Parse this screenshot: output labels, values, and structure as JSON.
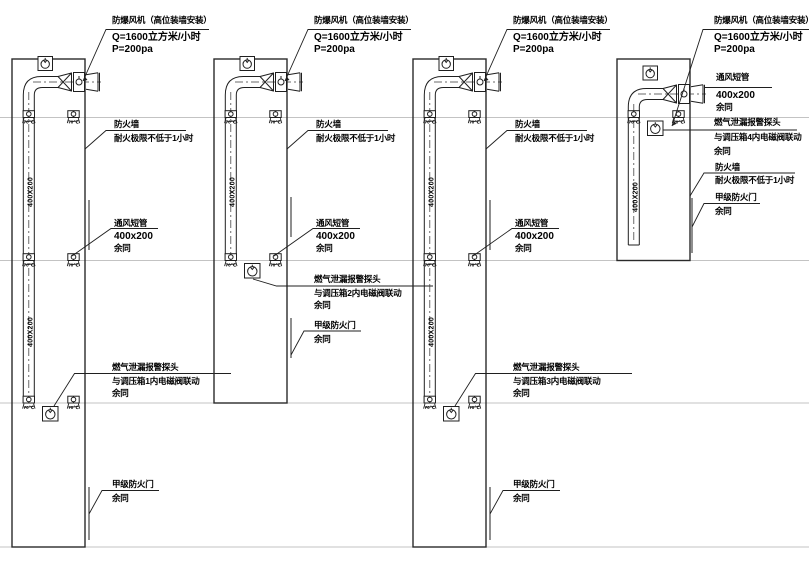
{
  "shared": {
    "duct_size_vertical": "400X200",
    "damper_temp": "70℃"
  },
  "panels": [
    {
      "fan_title": "防爆风机（高位装墙安装）",
      "fan_q": "Q=1600立方米/小时",
      "fan_p": "P=200pa",
      "firewall": "防火墙",
      "firewall_rating": "耐火极限不低于1小时",
      "vent": "通风短管",
      "vent_size": "400x200",
      "vent_same": "余同",
      "sensor": "燃气泄漏报警探头",
      "sensor_link": "与调压箱1内电磁阀联动",
      "sensor_same": "余同",
      "door": "甲级防火门",
      "door_same": "余同"
    },
    {
      "fan_title": "防爆风机（高位装墙安装）",
      "fan_q": "Q=1600立方米/小时",
      "fan_p": "P=200pa",
      "firewall": "防火墙",
      "firewall_rating": "耐火极限不低于1小时",
      "vent": "通风短管",
      "vent_size": "400x200",
      "vent_same": "余同",
      "sensor": "燃气泄漏报警探头",
      "sensor_link": "与调压箱2内电磁阀联动",
      "sensor_same": "余同",
      "door": "甲级防火门",
      "door_same": "余同"
    },
    {
      "fan_title": "防爆风机（高位装墙安装）",
      "fan_q": "Q=1600立方米/小时",
      "fan_p": "P=200pa",
      "firewall": "防火墙",
      "firewall_rating": "耐火极限不低于1小时",
      "vent": "通风短管",
      "vent_size": "400x200",
      "vent_same": "余同",
      "sensor": "燃气泄漏报警探头",
      "sensor_link": "与调压箱3内电磁阀联动",
      "sensor_same": "余同",
      "door": "甲级防火门",
      "door_same": "余同"
    },
    {
      "fan_title": "防爆风机（高位装墙安装）",
      "fan_q": "Q=1600立方米/小时",
      "fan_p": "P=200pa",
      "firewall": "防火墙",
      "firewall_rating": "耐火极限不低于1小时",
      "vent": "通风短管",
      "vent_size": "400x200",
      "vent_same": "余同",
      "sensor": "燃气泄漏报警探头",
      "sensor_link": "与调压箱4内电磁阀联动",
      "sensor_same": "余同",
      "door": "甲级防火门",
      "door_same": "余同"
    }
  ]
}
